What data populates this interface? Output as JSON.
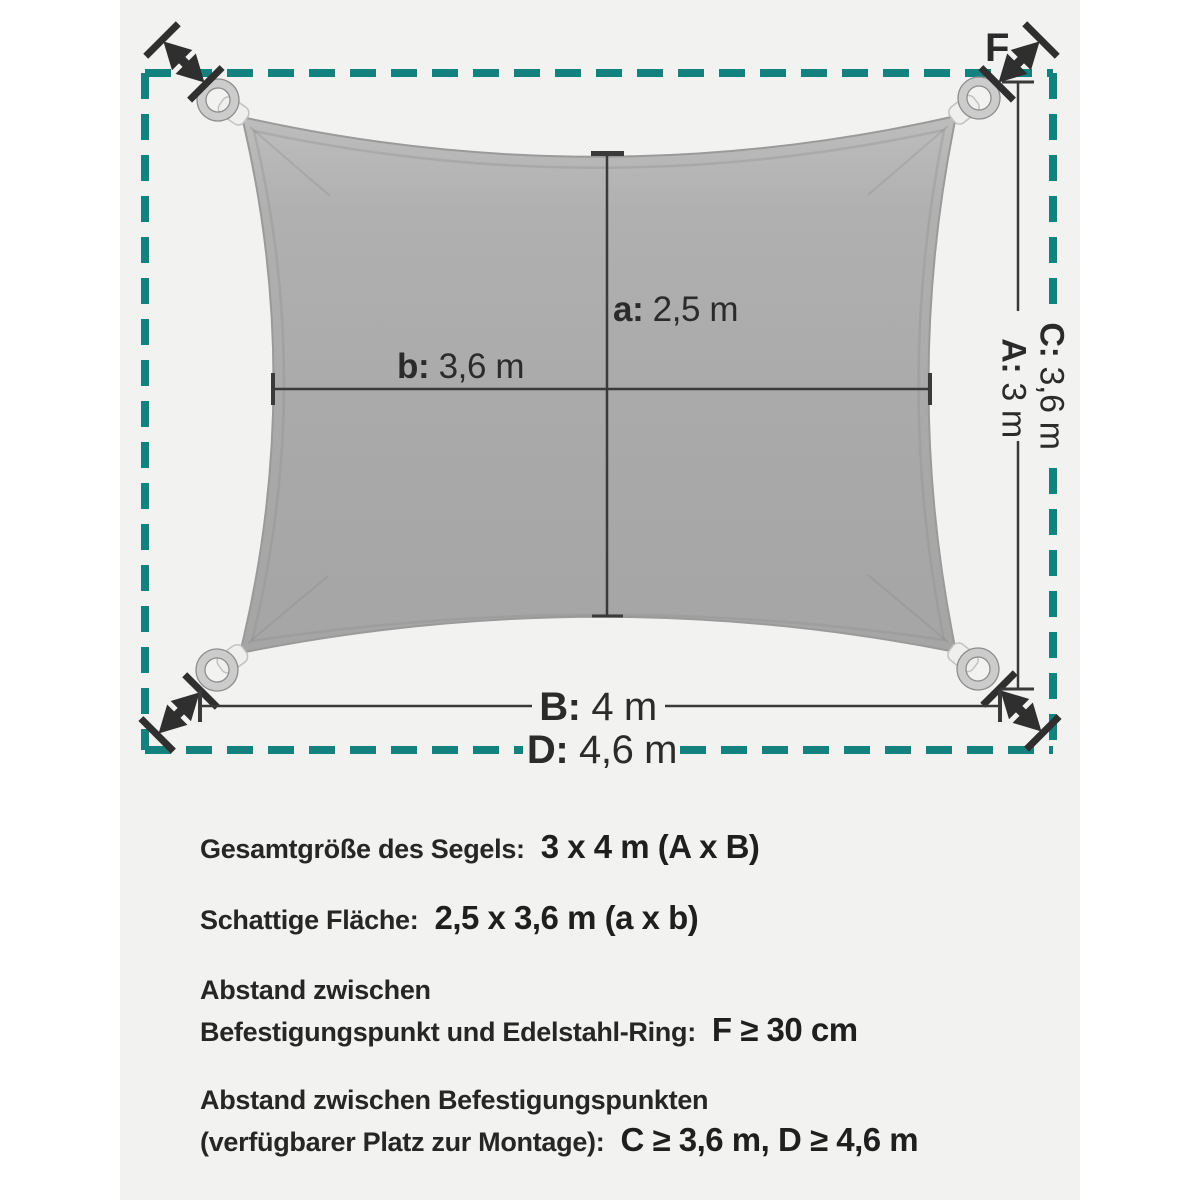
{
  "colors": {
    "accent_teal": "#13827e",
    "sail_gray": "#ababab",
    "canvas_gray": "#f2f2f0",
    "text_dark": "#262626"
  },
  "diagram": {
    "labels": {
      "f": "F",
      "a_key": "a:",
      "a_val": "2,5 m",
      "b_key": "b:",
      "b_val": "3,6 m",
      "c_key": "C:",
      "c_val": "3,6 m",
      "a_side_key": "A:",
      "a_side_val": "3 m",
      "b_bottom_key": "B:",
      "b_bottom_val": "4 m",
      "d_key": "D:",
      "d_val": "4,6 m"
    }
  },
  "specs": [
    {
      "label": "Gesamtgröße des Segels:",
      "value": "3 x 4 m (A x B)"
    },
    {
      "label": "Schattige Fläche:",
      "value": "2,5 x 3,6 m (a x b)"
    },
    {
      "label_line1": "Abstand zwischen",
      "label_line2": "Befestigungspunkt und Edelstahl-Ring:",
      "value": "F ≥ 30 cm"
    },
    {
      "label_line1": "Abstand zwischen Befestigungspunkten",
      "label_line2": "(verfügbarer Platz zur Montage):",
      "value": "C ≥ 3,6 m, D ≥ 4,6 m"
    }
  ]
}
